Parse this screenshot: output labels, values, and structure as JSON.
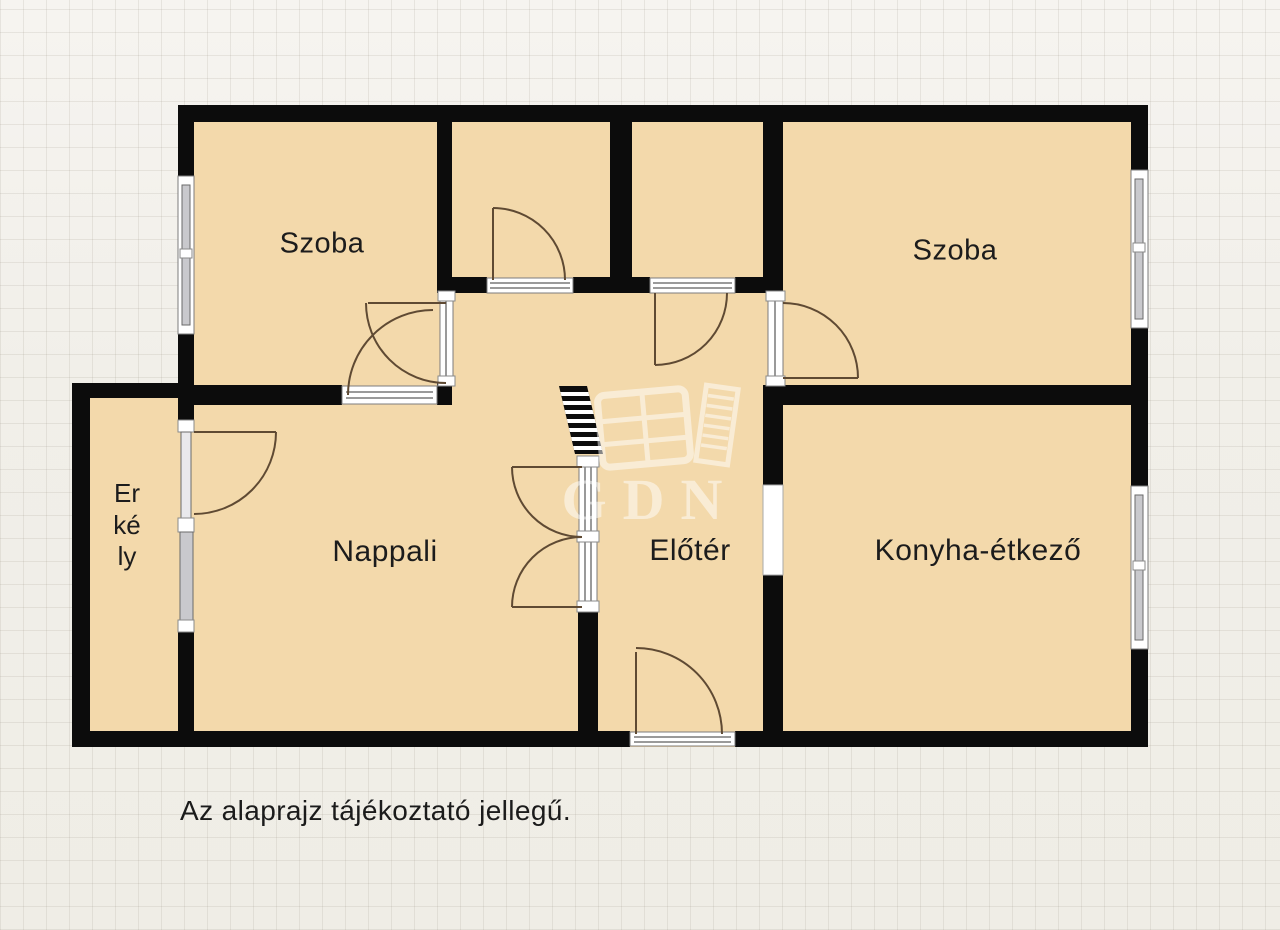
{
  "plan": {
    "rooms": {
      "szoba_left": {
        "label": "Szoba"
      },
      "szoba_right": {
        "label": "Szoba"
      },
      "nappali": {
        "label": "Nappali"
      },
      "eloter": {
        "label": "Előtér"
      },
      "konyha": {
        "label": "Konyha-étkező"
      },
      "erkely": {
        "label": "Erkély"
      }
    },
    "caption": "Az alaprajz tájékoztató jellegű.",
    "watermark": {
      "text": "GDN"
    },
    "colors": {
      "floor": "#f3d9ab",
      "wall": "#0c0c0c",
      "background": "#f1efe9",
      "grid_line": "#dcd8d1",
      "door_arc": "#5f4a33",
      "window_glass": "#c9c9cd",
      "threshold": "#ffffff",
      "watermark": "#ffffff",
      "label_text": "#1c1c1c"
    }
  }
}
